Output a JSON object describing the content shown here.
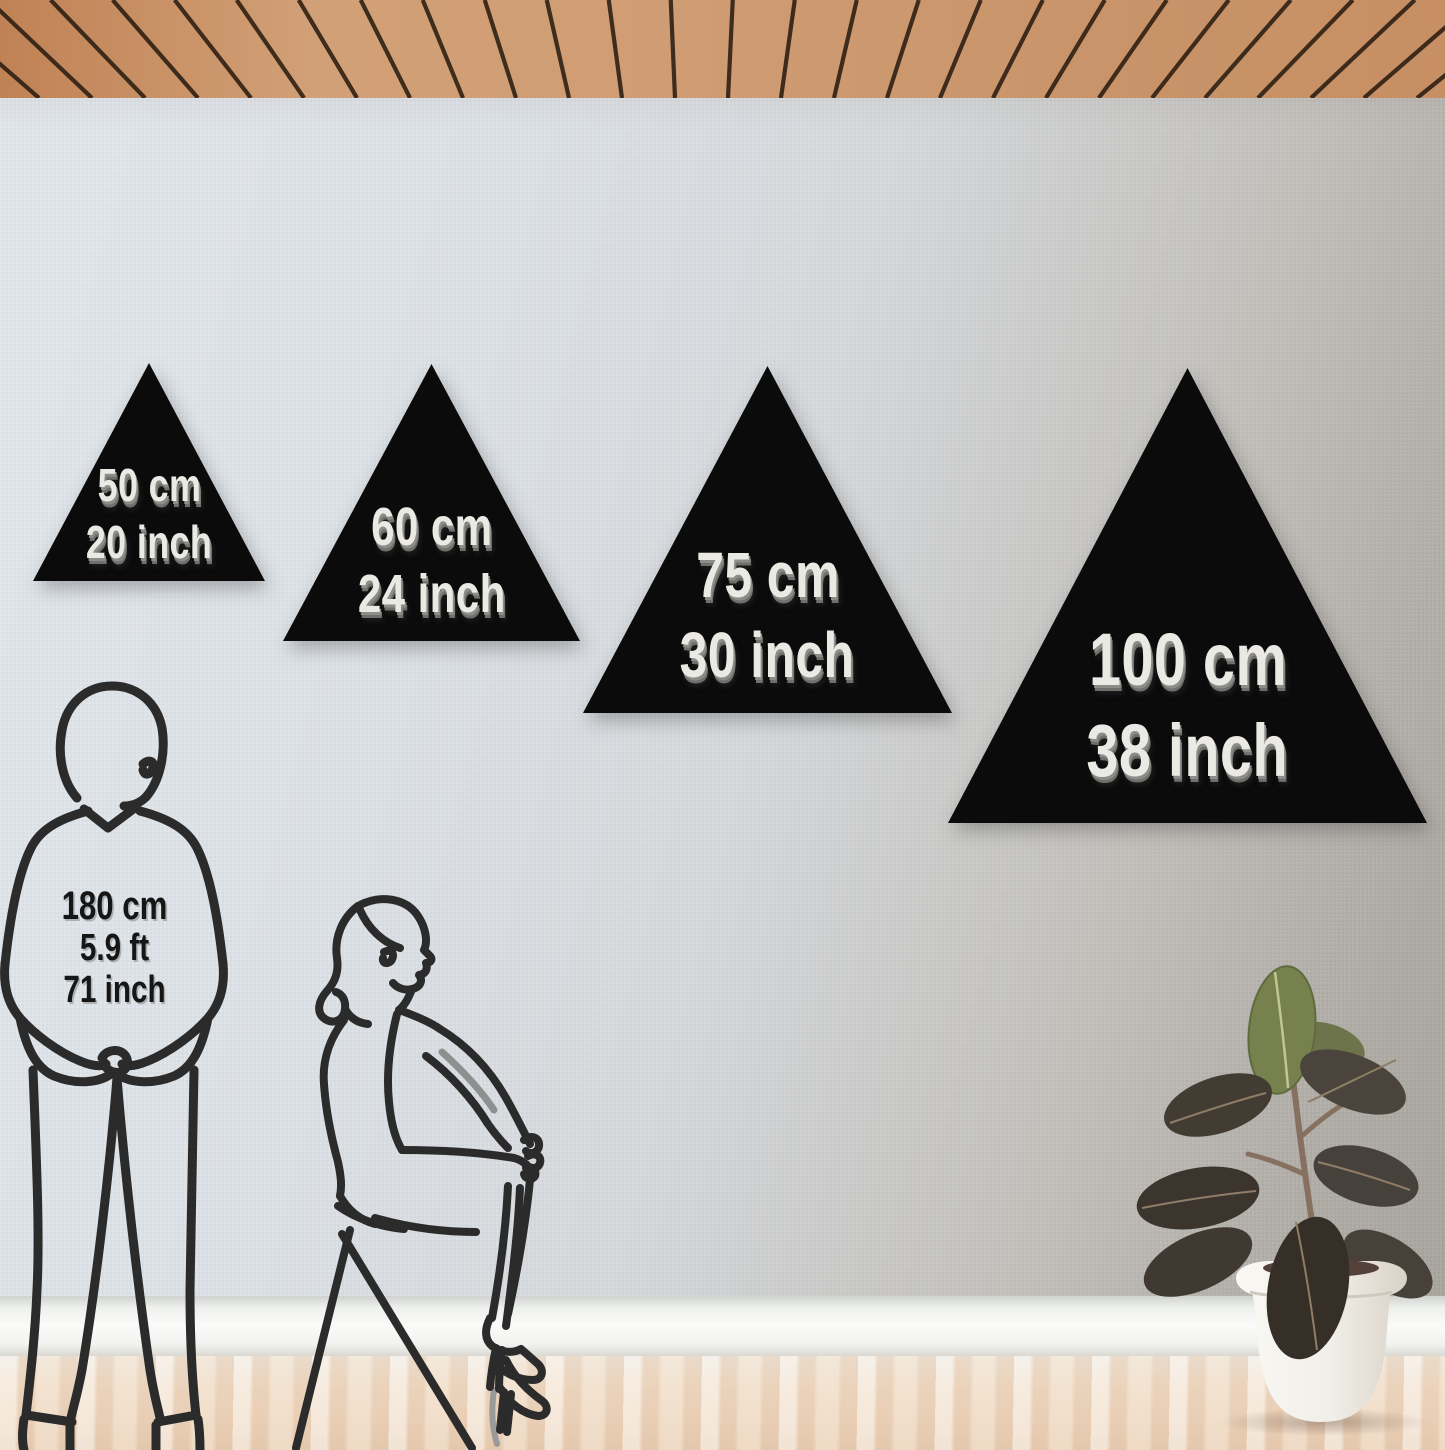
{
  "sizes": [
    {
      "cm": "50 cm",
      "inch": "20 inch"
    },
    {
      "cm": "60 cm",
      "inch": "24 inch"
    },
    {
      "cm": "75 cm",
      "inch": "30 inch"
    },
    {
      "cm": "100 cm",
      "inch": "38 inch"
    }
  ],
  "reference": {
    "lines": [
      "180 cm",
      "5.9 ft",
      "71 inch"
    ]
  },
  "objects": [
    "triangle-wall-decor",
    "standing-man-line-art",
    "sitting-woman-line-art",
    "potted-rubber-plant",
    "wood-slat-ceiling",
    "linen-texture-wall",
    "white-baseboard",
    "light-wood-floor"
  ],
  "colors": {
    "triangle_fill": "#0b0b0b",
    "size_text": "#ebe9e4",
    "size_text_shadow": "#7c7c79",
    "height_text": "#161616",
    "line_art": "#2b2b2b",
    "wall_left": "#e2e7ec",
    "wall_right": "#a8a49e",
    "baseboard": "#fafbf9",
    "floor_wood": "#eed9c2",
    "ceiling_wood": "#cf9c73",
    "ceiling_gap": "#2f2013",
    "pot": "#f3f1ed",
    "leaf_dark": "#3f3931",
    "leaf_green": "#76814e"
  }
}
